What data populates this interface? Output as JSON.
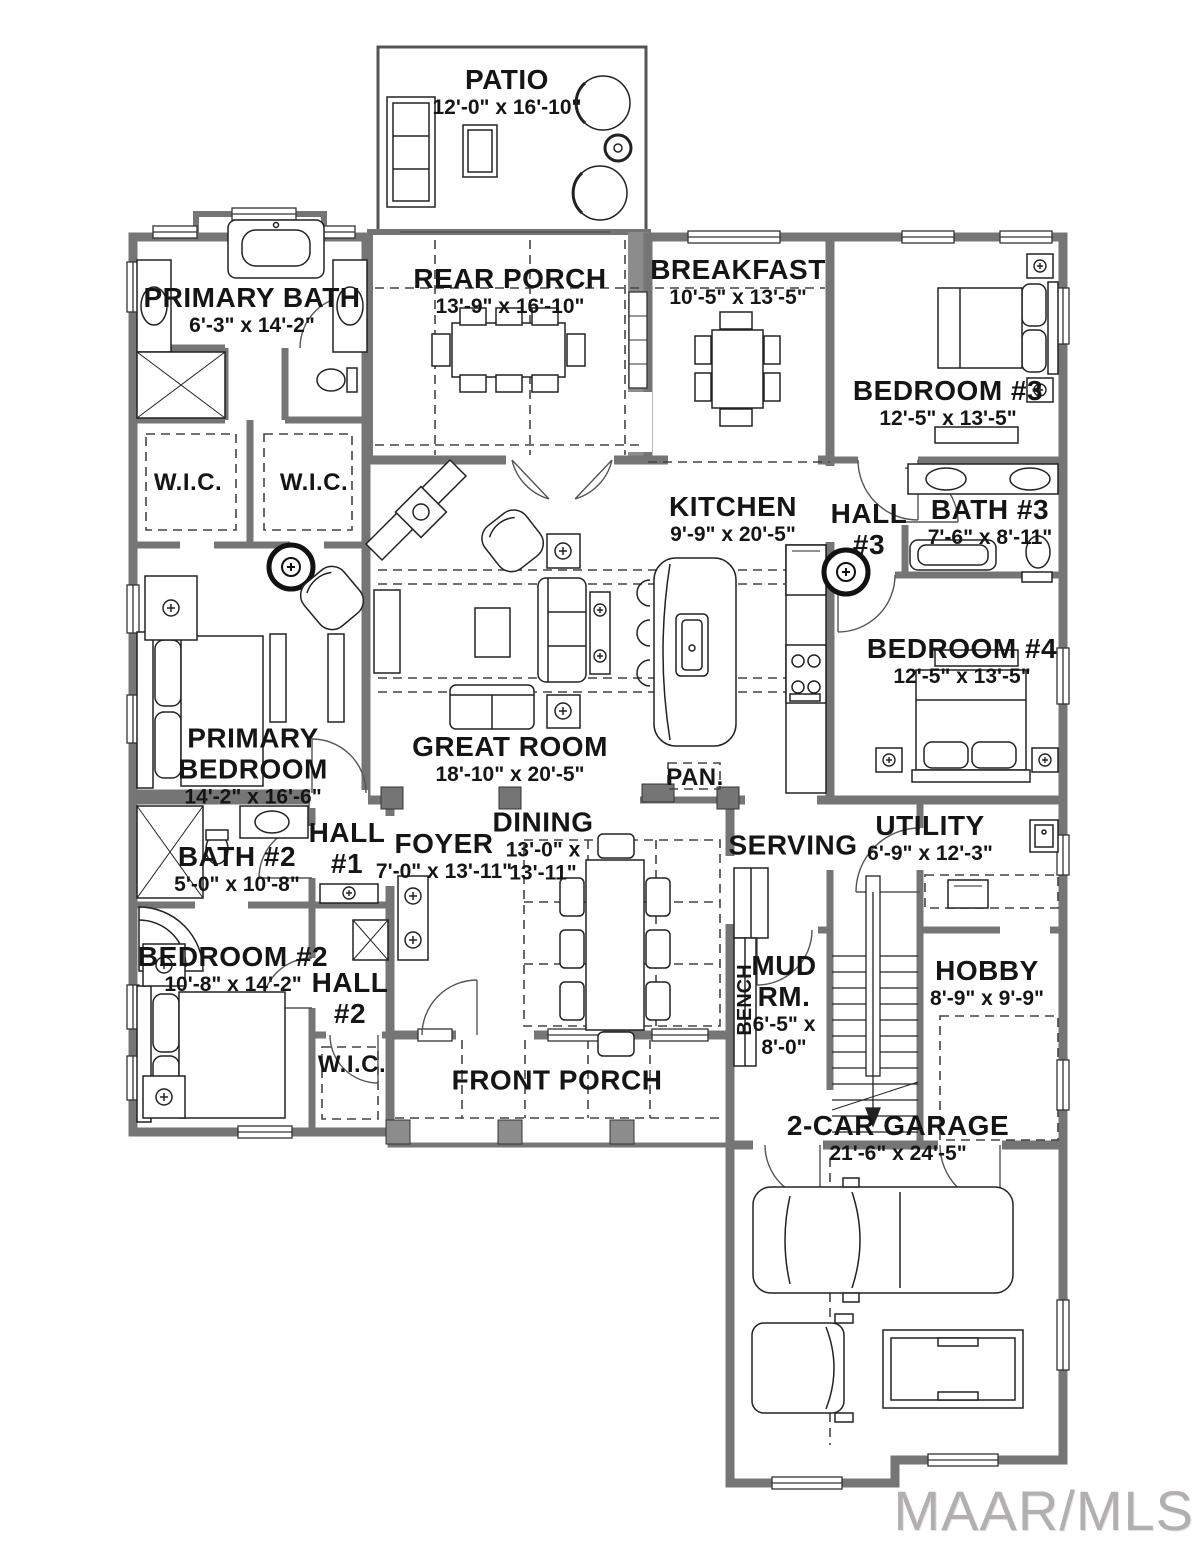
{
  "watermark": "MAAR/MLS",
  "colors": {
    "wall": "#757575",
    "text": "#151515",
    "watermark": "#b1afaf"
  },
  "rooms": {
    "patio": {
      "name": "PATIO",
      "dims": "12'-0\" x 16'-10\""
    },
    "rear_porch": {
      "name": "REAR PORCH",
      "dims": "13'-9\" x 16'-10\""
    },
    "breakfast": {
      "name": "BREAKFAST",
      "dims": "10'-5\" x 13'-5\""
    },
    "primary_bath": {
      "name": "PRIMARY BATH",
      "dims": "6'-3\" x 14'-2\""
    },
    "wic_left": {
      "name": "W.I.C."
    },
    "wic_right": {
      "name": "W.I.C."
    },
    "wic_bottom": {
      "name": "W.I.C."
    },
    "bedroom3": {
      "name": "BEDROOM #3",
      "dims": "12'-5\" x 13'-5\""
    },
    "kitchen": {
      "name": "KITCHEN",
      "dims": "9'-9\" x 20'-5\""
    },
    "hall3": {
      "name": "HALL",
      "number": "#3"
    },
    "bath3": {
      "name": "BATH #3",
      "dims": "7'-6\" x 8'-11\""
    },
    "bedroom4": {
      "name": "BEDROOM #4",
      "dims": "12'-5\" x 13'-5\""
    },
    "primary_bedroom": {
      "line1": "PRIMARY",
      "line2": "BEDROOM",
      "dims": "14'-2\" x 16'-6\""
    },
    "great_room": {
      "name": "GREAT ROOM",
      "dims": "18'-10\" x 20'-5\""
    },
    "pantry": {
      "name": "PAN."
    },
    "hall1": {
      "name": "HALL",
      "number": "#1"
    },
    "foyer": {
      "name": "FOYER",
      "dims": "7'-0\" x 13'-11\""
    },
    "dining": {
      "name": "DINING",
      "dims_line1": "13'-0\" x",
      "dims_line2": "13'-11\""
    },
    "serving": {
      "name": "SERVING"
    },
    "utility": {
      "name": "UTILITY",
      "dims": "6'-9\" x 12'-3\""
    },
    "bath2": {
      "name": "BATH #2",
      "dims": "5'-0\" x 10'-8\""
    },
    "bedroom2": {
      "name": "BEDROOM #2",
      "dims": "10'-8\" x 14'-2\""
    },
    "hall2": {
      "name": "HALL",
      "number": "#2"
    },
    "mud_room": {
      "line1": "MUD",
      "line2": "RM.",
      "dims_line1": "6'-5\" x",
      "dims_line2": "8'-0\""
    },
    "bench": {
      "name": "BENCH"
    },
    "hobby": {
      "name": "HOBBY",
      "dims": "8'-9\" x 9'-9\""
    },
    "front_porch": {
      "name": "FRONT PORCH"
    },
    "garage": {
      "name": "2-CAR GARAGE",
      "dims": "21'-6\" x 24'-5\""
    }
  }
}
